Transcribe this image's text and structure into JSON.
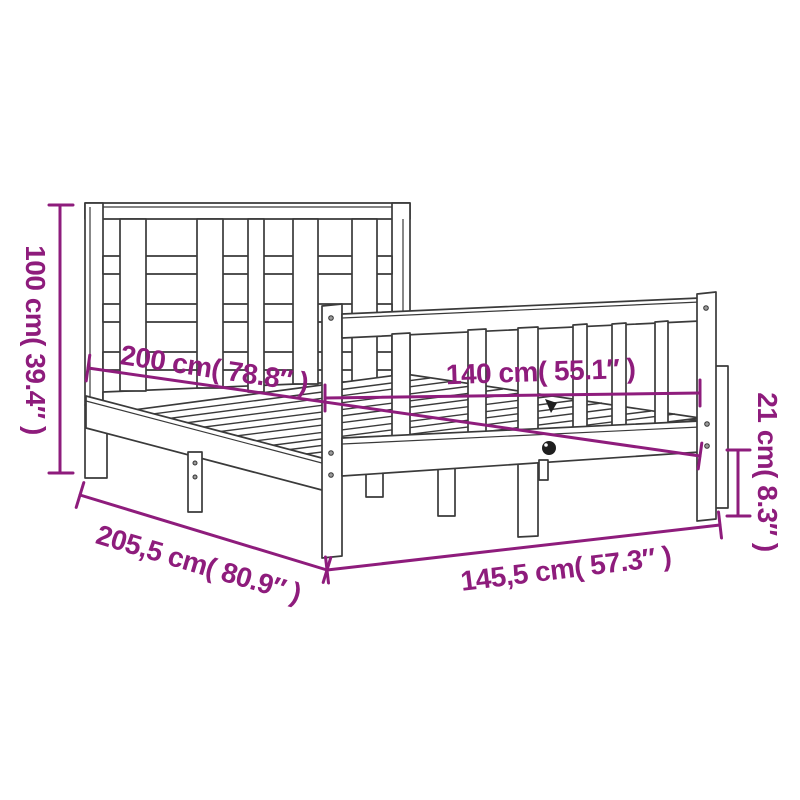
{
  "diagram": {
    "kind": "product-dimension-diagram",
    "subject": "bed-frame-with-headboard-and-footboard",
    "colors": {
      "accent": "#8e1c7c",
      "line": "#3a3a3a",
      "background": "#ffffff",
      "dark_detail": "#1f1f1f"
    },
    "dimensions": {
      "headboard_height": {
        "label": "100 cm( 39.4″ )",
        "cm": "100",
        "inches": "39.4"
      },
      "length_inner": {
        "label": "200 cm( 78.8″ )",
        "cm": "200",
        "inches": "78.8"
      },
      "width_inner": {
        "label": "140 cm( 55.1″ )",
        "cm": "140",
        "inches": "55.1"
      },
      "rail_height": {
        "label": "21 cm( 8.3″ )",
        "cm": "21",
        "inches": "8.3"
      },
      "length_total": {
        "label": "205,5 cm( 80.9″ )",
        "cm": "205,5",
        "inches": "80.9"
      },
      "width_total": {
        "label": "145,5 cm( 57.3″ )",
        "cm": "145,5",
        "inches": "57.3"
      }
    }
  }
}
